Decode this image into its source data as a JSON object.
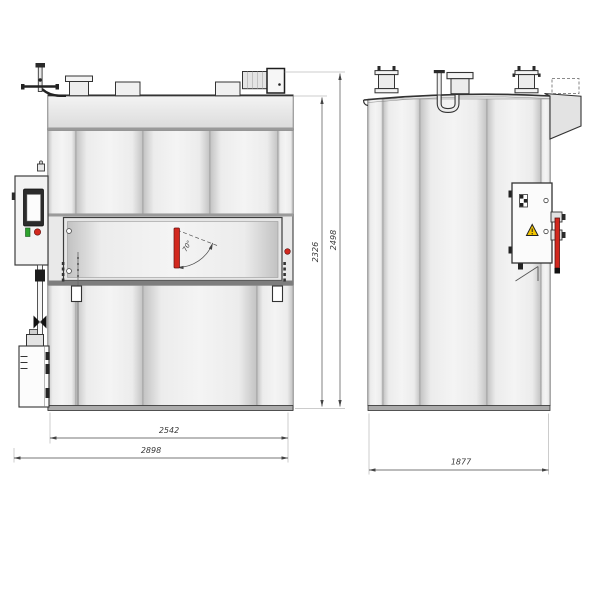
{
  "drawing": {
    "views": {
      "front": {
        "dims": {
          "inner_width": "2542",
          "overall_width": "2898",
          "body_height": "2326",
          "overall_height": "2498",
          "door_angle": "70°"
        }
      },
      "side": {
        "dims": {
          "depth": "1877"
        }
      }
    },
    "colors": {
      "line": "#3a3a3a",
      "accent_red": "#d2281e",
      "warning_yellow": "#f2c500",
      "indicator_green": "#2da32d",
      "panel_light": "#f2f2f2",
      "panel_dark": "#c4c4c4"
    }
  }
}
